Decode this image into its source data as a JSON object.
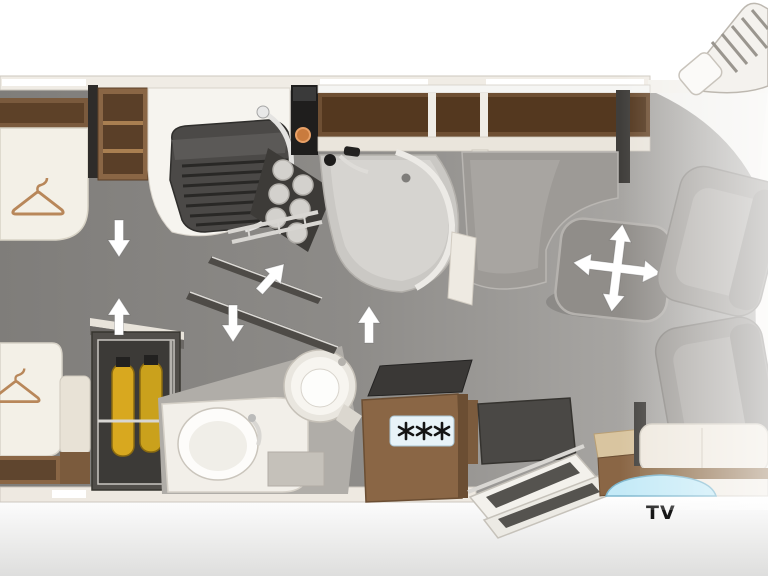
{
  "floorplan": {
    "type": "motorhome-top-view-floor-plan",
    "labels": {
      "tv": "TV"
    },
    "fridge": {
      "freezer_stars": 3,
      "star_symbol": "six-spoke-snowflake"
    },
    "icons": {
      "wardrobe_under_beds": "clothes-hanger-icon",
      "movable_table": "four-way-arrow-icon",
      "swivel-bathroom-walls": [
        "arrow-up-right-icon",
        "arrow-down-icon",
        "arrow-up-icon"
      ],
      "rear_bedroom_steps": [
        "arrow-down-icon",
        "arrow-up-icon"
      ]
    },
    "colors": {
      "carpet_dark": "#82807d",
      "carpet_light": "#b2b0ad",
      "wood": "#8a6645",
      "wood_dark": "#5d4128",
      "mattress": "#f3f0e7",
      "wall_cream": "#efe9e0",
      "bench_gray": "#9d9a96",
      "hob_dark": "#4b4947",
      "gas_bottle_yellow": "#d8a81f",
      "tv_screen_blue": "#c4eaf7",
      "freezer_label_bg": "#e8f3f8",
      "arrow_white": "#ffffff"
    }
  }
}
